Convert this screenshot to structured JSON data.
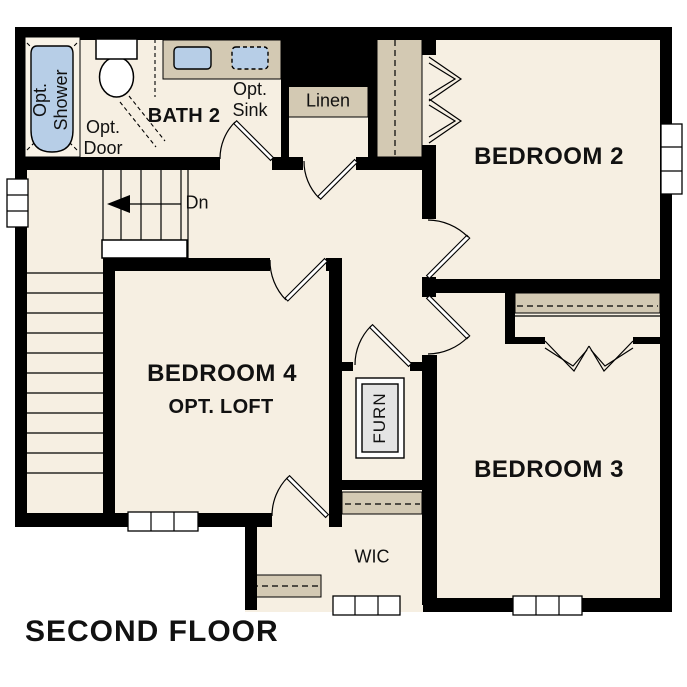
{
  "title": {
    "text": "SECOND FLOOR"
  },
  "rooms": {
    "bedroom_2": {
      "label": "BEDROOM 2"
    },
    "bedroom_3": {
      "label": "BEDROOM 3"
    },
    "bedroom_4": {
      "label": "BEDROOM 4",
      "sublabel": "OPT. LOFT"
    },
    "bath_2": {
      "label": "BATH 2"
    },
    "wic": {
      "label": "WIC"
    },
    "linen": {
      "label": "Linen"
    },
    "furnace": {
      "label": "FURN"
    }
  },
  "annotations": {
    "opt_shower": {
      "line1": "Opt.",
      "line2": "Shower"
    },
    "opt_door": {
      "line1": "Opt.",
      "line2": "Door"
    },
    "opt_sink": {
      "line1": "Opt.",
      "line2": "Sink"
    },
    "stair_direction": "Dn"
  },
  "colors": {
    "paper": "#ffffff",
    "floor": "#f6efe2",
    "wall": "#000000",
    "casework": "#d3c9b3",
    "fixture-blue": "#b7cee7",
    "furnace-gray": "#e4e4e4",
    "text": "#111111"
  }
}
